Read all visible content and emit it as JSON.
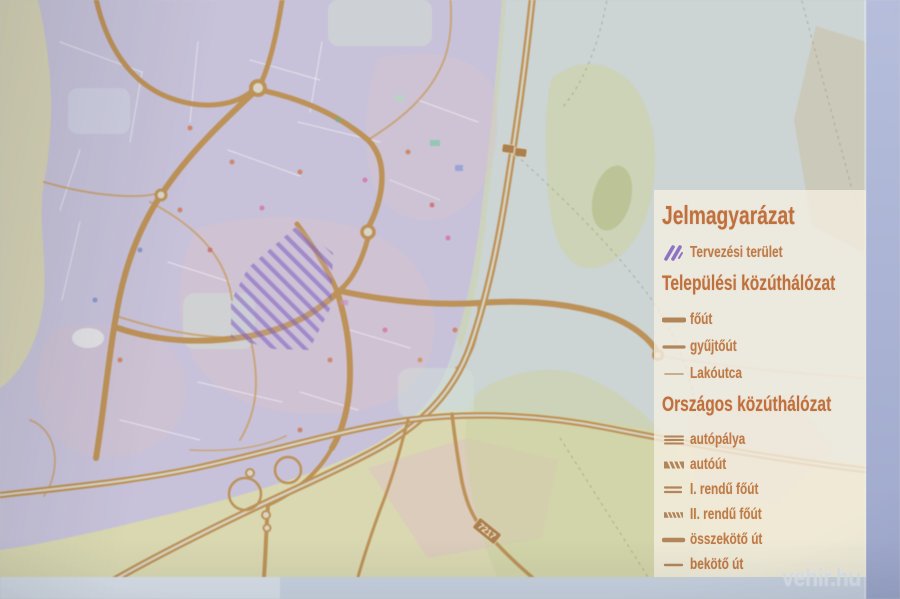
{
  "palette": {
    "photo-backdrop": "#c7cfd3",
    "screen-edge-right": "#aab3d3",
    "screen-edge-bottom": "#c9d3e0",
    "map-empty": "#ccd4d4",
    "urban-fill": "#c7c2d9",
    "field-green": "#dcd8a8",
    "veg-green": "#ccd2a2",
    "road-tan": "#bd9258",
    "road-minor": "#c8a06c",
    "planning-purple": "#7d5ec0",
    "legend-heading": "#c0703c",
    "legend-text": "#bf7a46",
    "legend-line": "#b3855a",
    "watermark": "#dde4ec"
  },
  "legend": {
    "title": "Jelmagyarázat",
    "planning_item": {
      "label": "Tervezési terület",
      "icon": "purple-hatch-icon"
    },
    "sections": [
      {
        "heading": "Települési közúthálózat",
        "items": [
          {
            "label": "főút",
            "icon": "thick-line-icon"
          },
          {
            "label": "gyűjtőút",
            "icon": "medium-line-icon"
          },
          {
            "label": "Lakóutca",
            "icon": "thin-line-icon"
          }
        ]
      },
      {
        "heading": "Országos közúthálózat",
        "items": [
          {
            "label": "autópálya",
            "icon": "triple-line-icon"
          },
          {
            "label": "autóút",
            "icon": "hatched-bar-icon"
          },
          {
            "label": "I. rendű főút",
            "icon": "double-line-icon"
          },
          {
            "label": "II. rendű főút",
            "icon": "hatched-double-line-icon"
          },
          {
            "label": "összekötő út",
            "icon": "thick-line-icon"
          },
          {
            "label": "bekötő út",
            "icon": "medium-line-icon"
          }
        ]
      }
    ]
  },
  "map": {
    "road_shield_label": "7217"
  },
  "watermark": "vehir.hu"
}
